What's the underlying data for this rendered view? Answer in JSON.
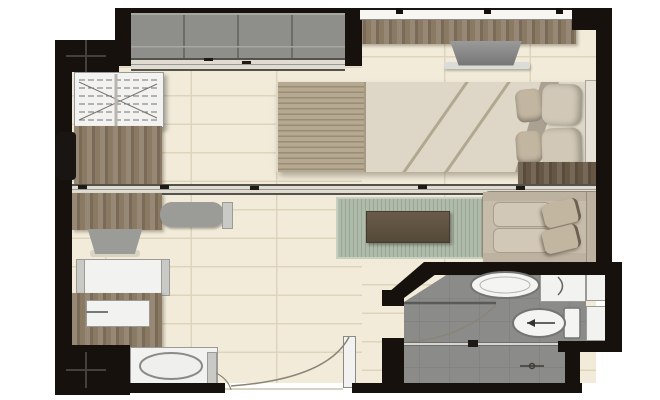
{
  "image": {
    "type": "floor-plan-render",
    "description": "Top-down 3D rendered floor plan of a one-bedroom condominium unit with balcony, bedroom, sliding partition, kitchen strip, living area and bathroom",
    "visible_text": []
  },
  "colors": {
    "outside": "#ffffff",
    "wall": "#16110d",
    "floor": "#f2ebd9",
    "grid": "#ded4bb",
    "balcony_floor": "#8e8e8a",
    "balcony_line": "#6c6c68",
    "balcony_light": "#a6a6a2",
    "track_bg": "#e0dcd1",
    "track_line": "#55524c",
    "track_mid": "#9a9a96",
    "wood": "#8a7a64",
    "wood_dark": "#655743",
    "table_dark": "#5e5142",
    "rug": "#b0bcab",
    "rug_line": "#99a692",
    "rug_border": "#c6cfc0",
    "sofa": "#c6bcab",
    "sofa_edge": "#938876",
    "cushion": "#d1c8b7",
    "pillow": "#c2b6a1",
    "pillow_dark": "#6d6051",
    "duvet": "#ded7c8",
    "duvet_fold": "#b2a890",
    "blanket": "#b6a992",
    "blanket_line": "#9a8d74",
    "headboard": "#e6e2d8",
    "tv": "#878787",
    "shelf_light": "#dcdcd6",
    "gray_item": "#9b9b97",
    "white_item": "#f2f2f0",
    "item_line": "#9a9a96",
    "cap": "#c9c9c5",
    "bath_floor": "#8b8b89",
    "bath_grid": "#7b7b79",
    "fixture": "#f4f4f2",
    "fixture_line": "#747472",
    "glass": "#d5d5d1",
    "arc": "#8a8474"
  },
  "rooms": [
    {
      "name": "balcony",
      "items": [
        "decking",
        "sliding-glass-door"
      ]
    },
    {
      "name": "bedroom",
      "items": [
        "window",
        "tv-console",
        "tv",
        "double-bed",
        "striped-runner",
        "duvet",
        "pillows",
        "headboard",
        "wardrobe",
        "desk",
        "desk-chair",
        "bedside-dresser"
      ]
    },
    {
      "name": "living-kitchen",
      "items": [
        "sliding-partition",
        "kitchen-counter",
        "bench",
        "chair",
        "table",
        "counter-with-sink",
        "sink-unit",
        "rug",
        "coffee-table",
        "sofa",
        "entrance-door"
      ]
    },
    {
      "name": "bathroom",
      "items": [
        "bathroom-door",
        "washbasin",
        "vanity-counter",
        "wall-niches",
        "toilet",
        "shower-screen",
        "shower-mixer",
        "tiled-floor"
      ]
    }
  ],
  "structure": [
    "exterior-walls",
    "interior-walls",
    "column-markers"
  ]
}
